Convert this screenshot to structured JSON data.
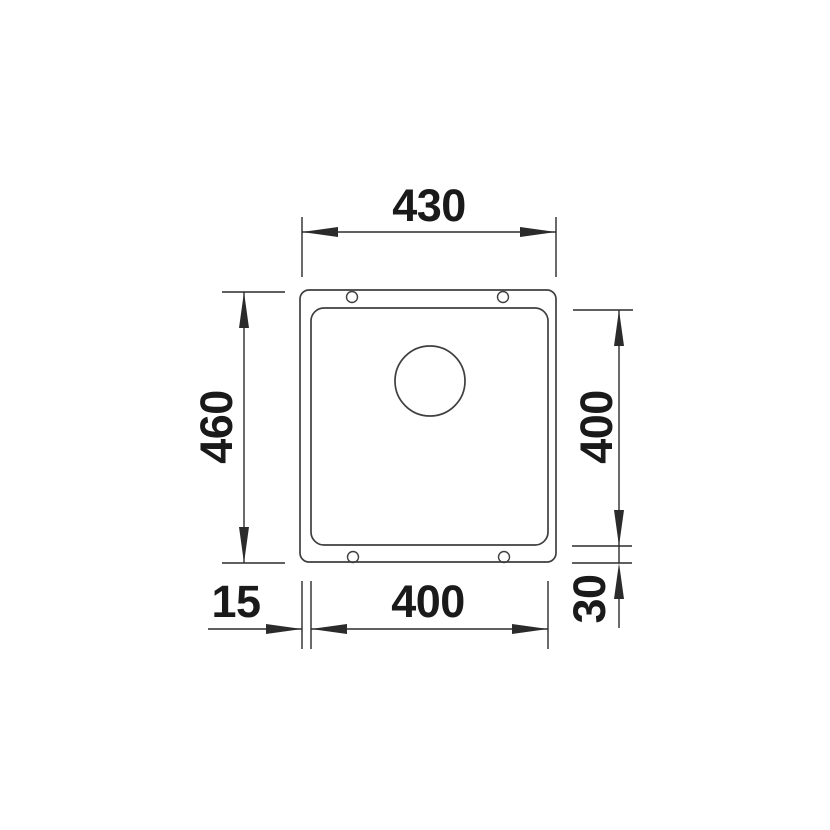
{
  "drawing": {
    "kind": "technical-dimension-drawing",
    "subject": "undermount-sink-plan-view",
    "dimensions": {
      "outer_width": "430",
      "outer_height": "460",
      "bowl_width": "400",
      "bowl_height": "400",
      "left_rim": "15",
      "bottom_rim": "30"
    },
    "features": {
      "drain_hole": "drain-hole-circle",
      "mounting_holes_count": 4
    },
    "colors": {
      "outline": "#3f3f3f",
      "dimension": "#2b2b2b",
      "text": "#1a1a1a",
      "background": "#ffffff"
    }
  }
}
